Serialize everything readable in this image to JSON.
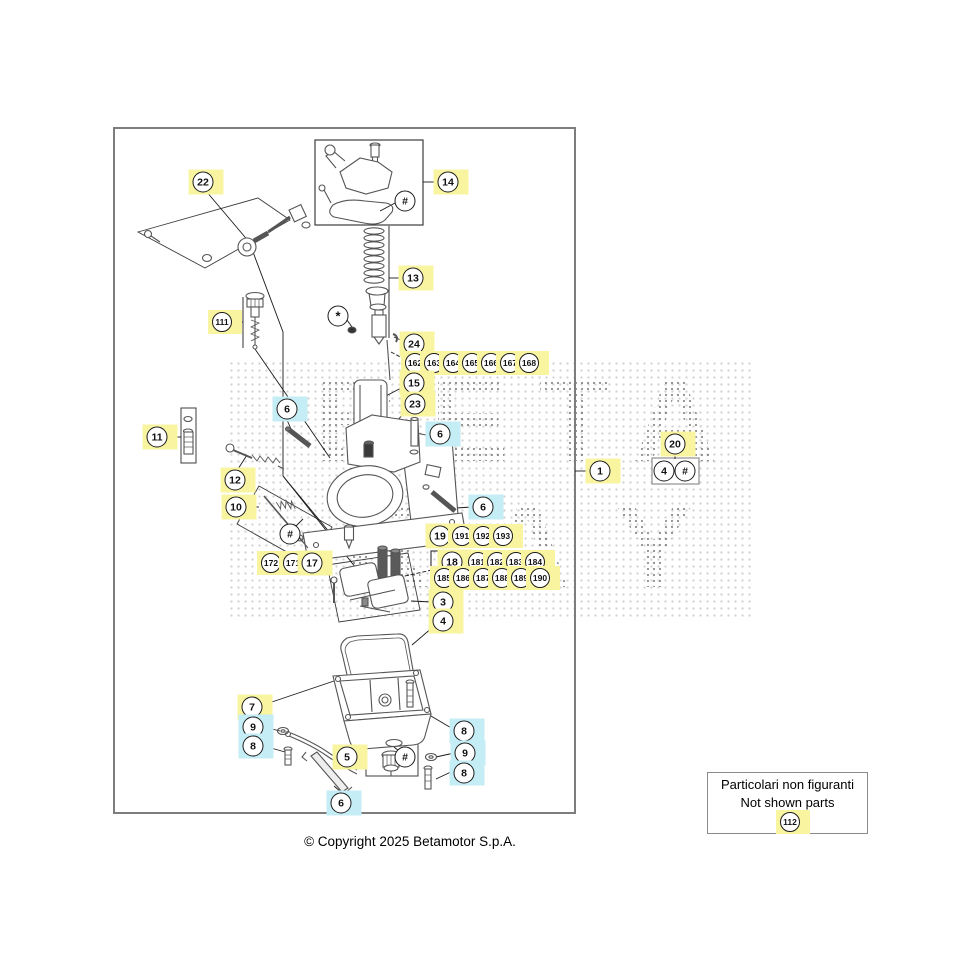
{
  "watermark": {
    "line1": "BETA",
    "line2": "RAY"
  },
  "copyright": "© Copyright 2025 Betamotor S.p.A.",
  "not_shown_box": {
    "line1": "Particolari non figuranti",
    "line2": "Not shown parts",
    "callout": "112"
  },
  "colors": {
    "highlight_yellow": "#F8F4A0",
    "highlight_cyan": "#C5EDF6",
    "frame_border": "#7D7D7D",
    "art_line": "#555555"
  },
  "callouts": [
    {
      "label": "22",
      "x": 203,
      "y": 182,
      "hl": "yellow"
    },
    {
      "label": "14",
      "x": 448,
      "y": 182,
      "hl": "yellow"
    },
    {
      "label": "#",
      "x": 405,
      "y": 201,
      "hl": "none"
    },
    {
      "label": "13",
      "x": 413,
      "y": 278,
      "hl": "yellow"
    },
    {
      "label": "*",
      "x": 338,
      "y": 316,
      "hl": "none"
    },
    {
      "label": "111",
      "x": 222,
      "y": 322,
      "hl": "yellow"
    },
    {
      "label": "24",
      "x": 414,
      "y": 344,
      "hl": "yellow"
    },
    {
      "label": "162",
      "x": 415,
      "y": 363,
      "hl": "yellow"
    },
    {
      "label": "163",
      "x": 434,
      "y": 363,
      "hl": "yellow"
    },
    {
      "label": "164",
      "x": 453,
      "y": 363,
      "hl": "yellow"
    },
    {
      "label": "165",
      "x": 472,
      "y": 363,
      "hl": "yellow"
    },
    {
      "label": "166",
      "x": 491,
      "y": 363,
      "hl": "yellow"
    },
    {
      "label": "167",
      "x": 510,
      "y": 363,
      "hl": "yellow"
    },
    {
      "label": "168",
      "x": 529,
      "y": 363,
      "hl": "yellow"
    },
    {
      "label": "15",
      "x": 414,
      "y": 383,
      "hl": "yellow"
    },
    {
      "label": "23",
      "x": 415,
      "y": 404,
      "hl": "yellow"
    },
    {
      "label": "6",
      "x": 287,
      "y": 409,
      "hl": "cyan"
    },
    {
      "label": "6",
      "x": 440,
      "y": 434,
      "hl": "cyan"
    },
    {
      "label": "11",
      "x": 157,
      "y": 437,
      "hl": "yellow"
    },
    {
      "label": "20",
      "x": 675,
      "y": 444,
      "hl": "yellow"
    },
    {
      "label": "4",
      "x": 664,
      "y": 471,
      "hl": "none"
    },
    {
      "label": "#",
      "x": 685,
      "y": 471,
      "hl": "none"
    },
    {
      "label": "1",
      "x": 600,
      "y": 471,
      "hl": "yellow"
    },
    {
      "label": "12",
      "x": 235,
      "y": 480,
      "hl": "yellow"
    },
    {
      "label": "10",
      "x": 236,
      "y": 507,
      "hl": "yellow"
    },
    {
      "label": "6",
      "x": 483,
      "y": 507,
      "hl": "cyan"
    },
    {
      "label": "#",
      "x": 290,
      "y": 534,
      "hl": "none"
    },
    {
      "label": "19",
      "x": 440,
      "y": 536,
      "hl": "yellow"
    },
    {
      "label": "191",
      "x": 462,
      "y": 536,
      "hl": "yellow"
    },
    {
      "label": "192",
      "x": 483,
      "y": 536,
      "hl": "yellow"
    },
    {
      "label": "193",
      "x": 503,
      "y": 536,
      "hl": "yellow"
    },
    {
      "label": "18",
      "x": 452,
      "y": 562,
      "hl": "yellow"
    },
    {
      "label": "181",
      "x": 478,
      "y": 562,
      "hl": "yellow"
    },
    {
      "label": "182",
      "x": 497,
      "y": 562,
      "hl": "yellow"
    },
    {
      "label": "183",
      "x": 516,
      "y": 562,
      "hl": "yellow"
    },
    {
      "label": "184",
      "x": 535,
      "y": 562,
      "hl": "yellow"
    },
    {
      "label": "185",
      "x": 444,
      "y": 578,
      "hl": "yellow"
    },
    {
      "label": "186",
      "x": 463,
      "y": 578,
      "hl": "yellow"
    },
    {
      "label": "187",
      "x": 483,
      "y": 578,
      "hl": "yellow"
    },
    {
      "label": "188",
      "x": 502,
      "y": 578,
      "hl": "yellow"
    },
    {
      "label": "189",
      "x": 521,
      "y": 578,
      "hl": "yellow"
    },
    {
      "label": "190",
      "x": 540,
      "y": 578,
      "hl": "yellow"
    },
    {
      "label": "172",
      "x": 271,
      "y": 563,
      "hl": "yellow"
    },
    {
      "label": "171",
      "x": 293,
      "y": 563,
      "hl": "yellow"
    },
    {
      "label": "17",
      "x": 312,
      "y": 563,
      "hl": "yellow"
    },
    {
      "label": "3",
      "x": 443,
      "y": 602,
      "hl": "yellow"
    },
    {
      "label": "4",
      "x": 443,
      "y": 621,
      "hl": "yellow"
    },
    {
      "label": "7",
      "x": 252,
      "y": 707,
      "hl": "yellow"
    },
    {
      "label": "9",
      "x": 253,
      "y": 727,
      "hl": "cyan"
    },
    {
      "label": "8",
      "x": 253,
      "y": 746,
      "hl": "cyan"
    },
    {
      "label": "5",
      "x": 347,
      "y": 757,
      "hl": "yellow"
    },
    {
      "label": "#",
      "x": 405,
      "y": 757,
      "hl": "none"
    },
    {
      "label": "8",
      "x": 464,
      "y": 731,
      "hl": "cyan"
    },
    {
      "label": "9",
      "x": 465,
      "y": 753,
      "hl": "cyan"
    },
    {
      "label": "8",
      "x": 464,
      "y": 773,
      "hl": "cyan"
    },
    {
      "label": "6",
      "x": 341,
      "y": 803,
      "hl": "cyan"
    },
    {
      "label": "112",
      "x": 790,
      "y": 822,
      "hl": "yellow"
    }
  ]
}
